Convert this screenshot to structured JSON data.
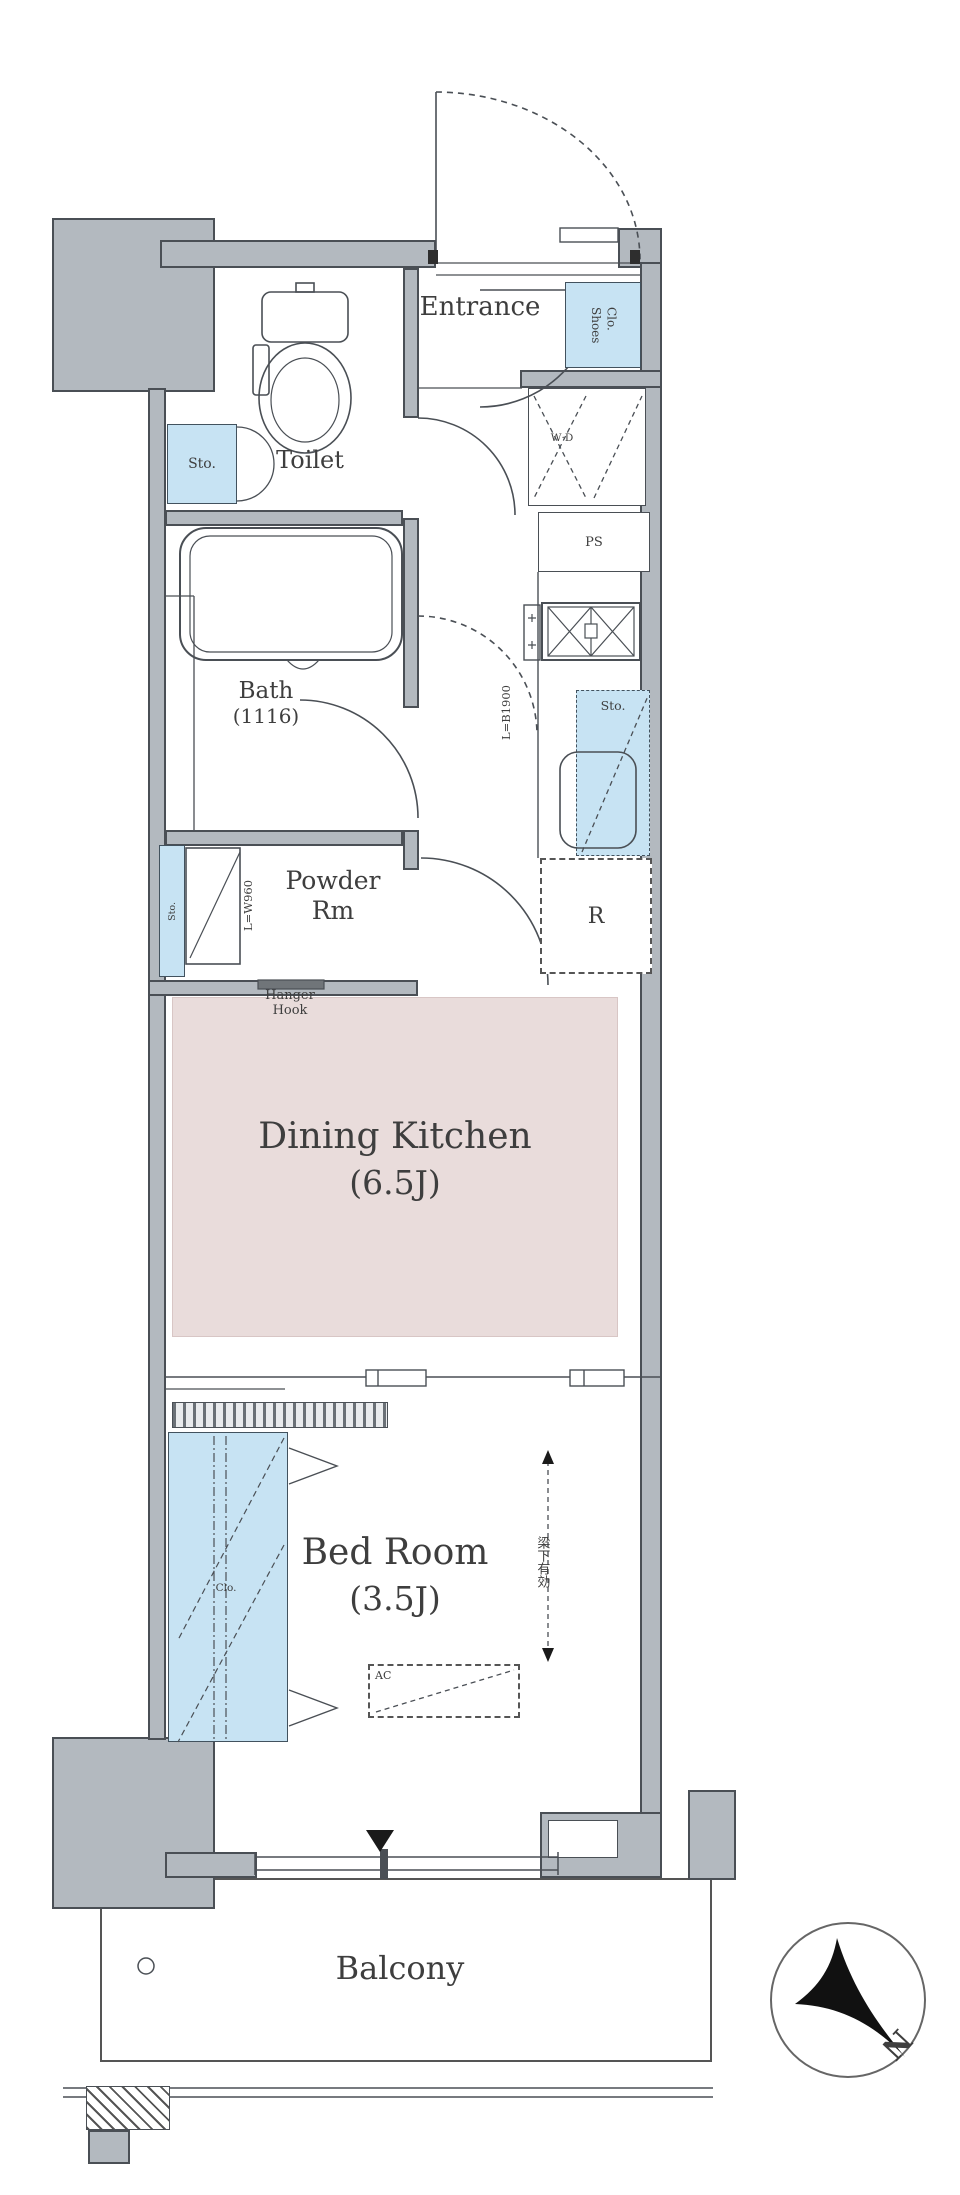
{
  "labels": {
    "entrance": "Entrance",
    "shoes_line1": "Shoes",
    "shoes_line2": "Clo.",
    "toilet": "Toilet",
    "toilet_storage": "Sto.",
    "bath_name": "Bath",
    "bath_size": "(1116)",
    "powder_line1": "Powder",
    "powder_line2": "Rm",
    "powder_storage": "Sto.",
    "vanity_width": "L=W960",
    "hanger_line1": "Hanger",
    "hanger_line2": "Hook",
    "washer_dryer": "W·D",
    "washer_storage": "Sto.",
    "pipe_space": "PS",
    "kitchen_length": "L=B1900",
    "sink_storage": "Sto.",
    "refrigerator": "R",
    "dk_name": "Dining Kitchen",
    "dk_size": "(6.5J)",
    "bedroom_name": "Bed Room",
    "bedroom_size": "(3.5J)",
    "closet": "Clo.",
    "beam_note": "梁下有効",
    "ac": "AC",
    "balcony": "Balcony",
    "compass_north": "N"
  },
  "colors": {
    "wall_gray": "#b3b9bf",
    "storage_blue": "#c7e3f3",
    "dk_pink": "#e9dcdb",
    "line": "#4a4f55",
    "text": "#3e3e3e"
  }
}
